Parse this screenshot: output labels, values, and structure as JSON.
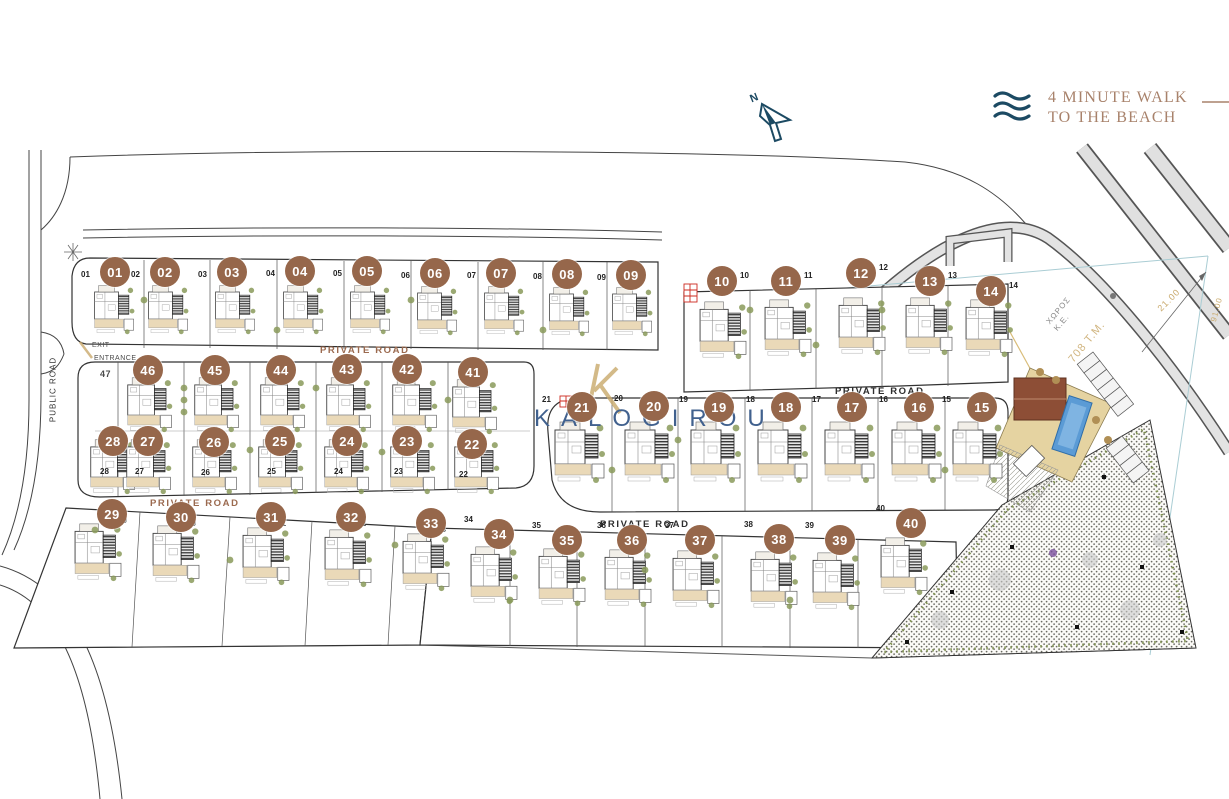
{
  "legend": {
    "walk_line1": "4 MINUTE WALK",
    "walk_line2": "TO THE BEACH"
  },
  "compass": {
    "north": "N"
  },
  "brand": {
    "name": "KALOGIROU"
  },
  "road_labels": {
    "public": "PUBLIC ROAD",
    "private_top": "PRIVATE ROAD",
    "private_mid": "PRIVATE ROAD",
    "private_lower_left": "PRIVATE ROAD",
    "private_lower_mid": "PRIVATE ROAD",
    "exit": "EXIT",
    "entrance": "ENTRANCE"
  },
  "site_texts": {
    "plot47": "47",
    "open_space_line1": "ΧΩΡΟΣ",
    "open_space_line2": "Κ.Ε.",
    "area_label": "708 Τ.Μ.",
    "dim_a": "21.00",
    "dim_b": "91.00"
  },
  "badges": [
    "01",
    "02",
    "03",
    "04",
    "05",
    "06",
    "07",
    "08",
    "09",
    "10",
    "11",
    "12",
    "13",
    "14",
    "46",
    "45",
    "44",
    "43",
    "42",
    "41",
    "21",
    "20",
    "19",
    "18",
    "17",
    "16",
    "15",
    "28",
    "27",
    "26",
    "25",
    "24",
    "23",
    "22",
    "29",
    "30",
    "31",
    "32",
    "33",
    "34",
    "35",
    "36",
    "37",
    "38",
    "39",
    "40"
  ],
  "colors": {
    "badge": "#96674b",
    "brand_blue": "#41618e",
    "legend_brown": "#a8826b",
    "navy": "#1c4a63",
    "gold": "#c9a96b",
    "road_label_brown": "#9b6a4f",
    "pool": "#5b9bd5",
    "court": "#8d4e36",
    "deck": "#e5d3a1",
    "tree_green": "#8a9a5b"
  }
}
